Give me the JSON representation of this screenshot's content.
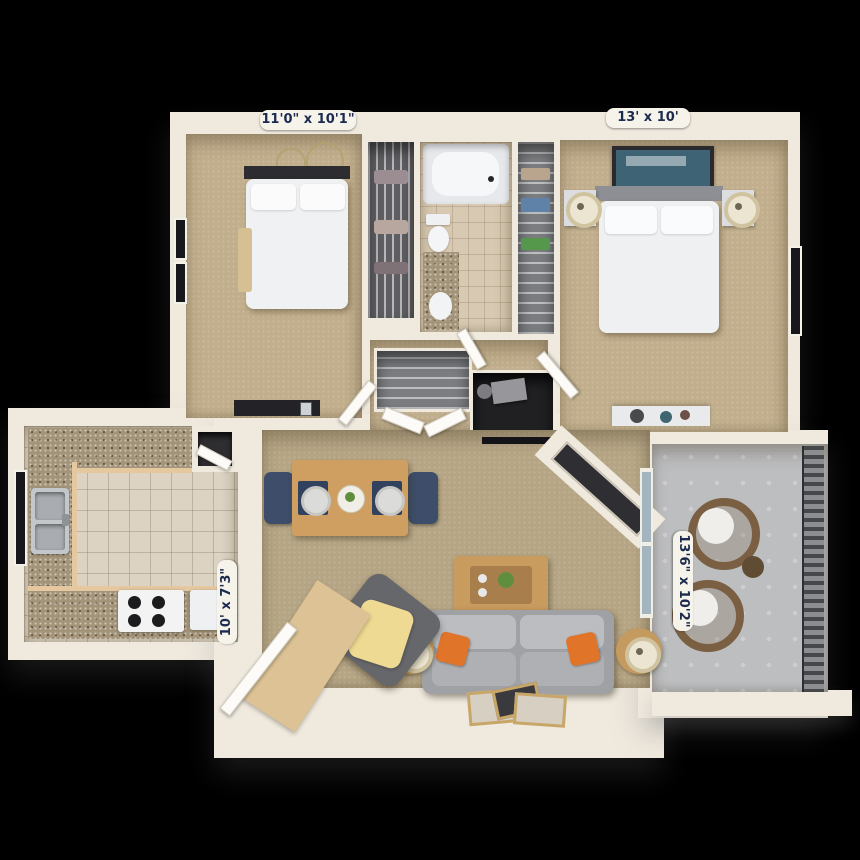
{
  "scene": {
    "description": "3D top-down floor plan rendering of a two-bedroom, one-bath apartment with kitchen, dining area, living room and balcony on a black background"
  },
  "dimension_labels": {
    "bedroom_left": "11'0\" x 10'1\"",
    "bedroom_right": "13' x 10'",
    "kitchen": "10' x 7'3\"",
    "living_room": "13'6\" x 10'2\""
  },
  "label_style": {
    "text_color": "#1b2a4e",
    "background_color": "#f6f3ea"
  },
  "palette": {
    "background": "#000000",
    "wall": "#efe9de",
    "bedroom_carpet": "#c1ae8c",
    "living_carpet": "#b5a584",
    "kitchen_tile": "#ddd3c3",
    "bathroom_tile": "#d8cab2",
    "cabinet": "#e5c7a0",
    "countertop_granite": "#a39378",
    "balcony_concrete": "#bdbec0",
    "sofa_gray": "#a0a2a6",
    "pillow_orange": "#e0752a",
    "throw_yellow": "#eeda92",
    "wood": "#c89b5f",
    "dining_chair_navy": "#3d4d6a"
  }
}
